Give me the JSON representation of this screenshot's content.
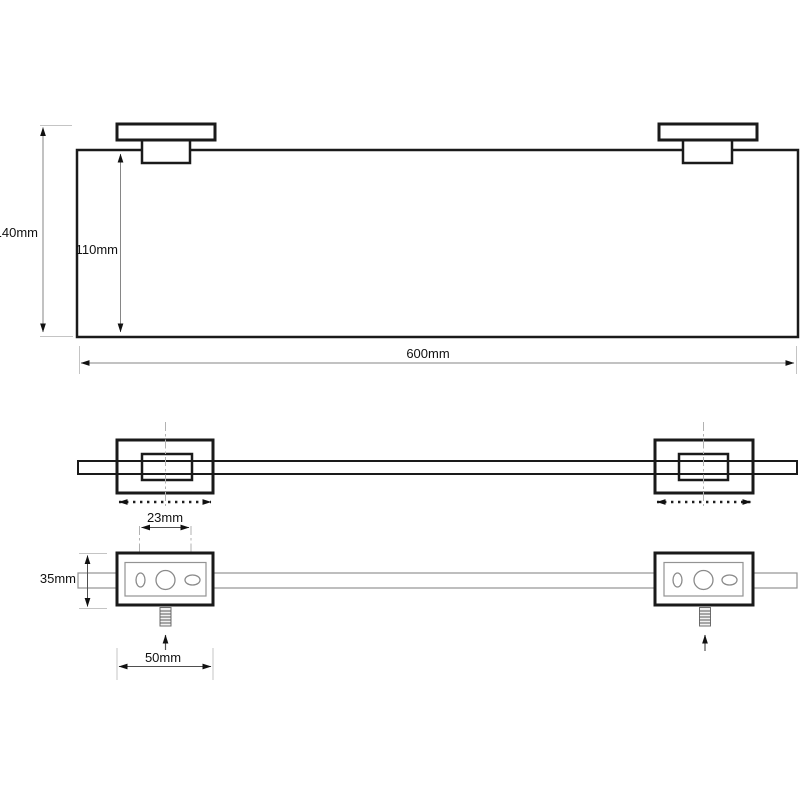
{
  "drawing": {
    "kind": "shelf-mounting-technical-drawing",
    "labels": {
      "overall_height": "140mm",
      "glass_height": "110mm",
      "overall_width": "600mm",
      "hole_spacing": "23mm",
      "bracket_height": "35mm",
      "bracket_width": "50mm"
    },
    "colors": {
      "line": "#1a1a1a",
      "dimension_line": "#868686",
      "extension_line": "#c4c4c4",
      "centerline": "#b2b2b2",
      "background": "#ffffff"
    }
  }
}
